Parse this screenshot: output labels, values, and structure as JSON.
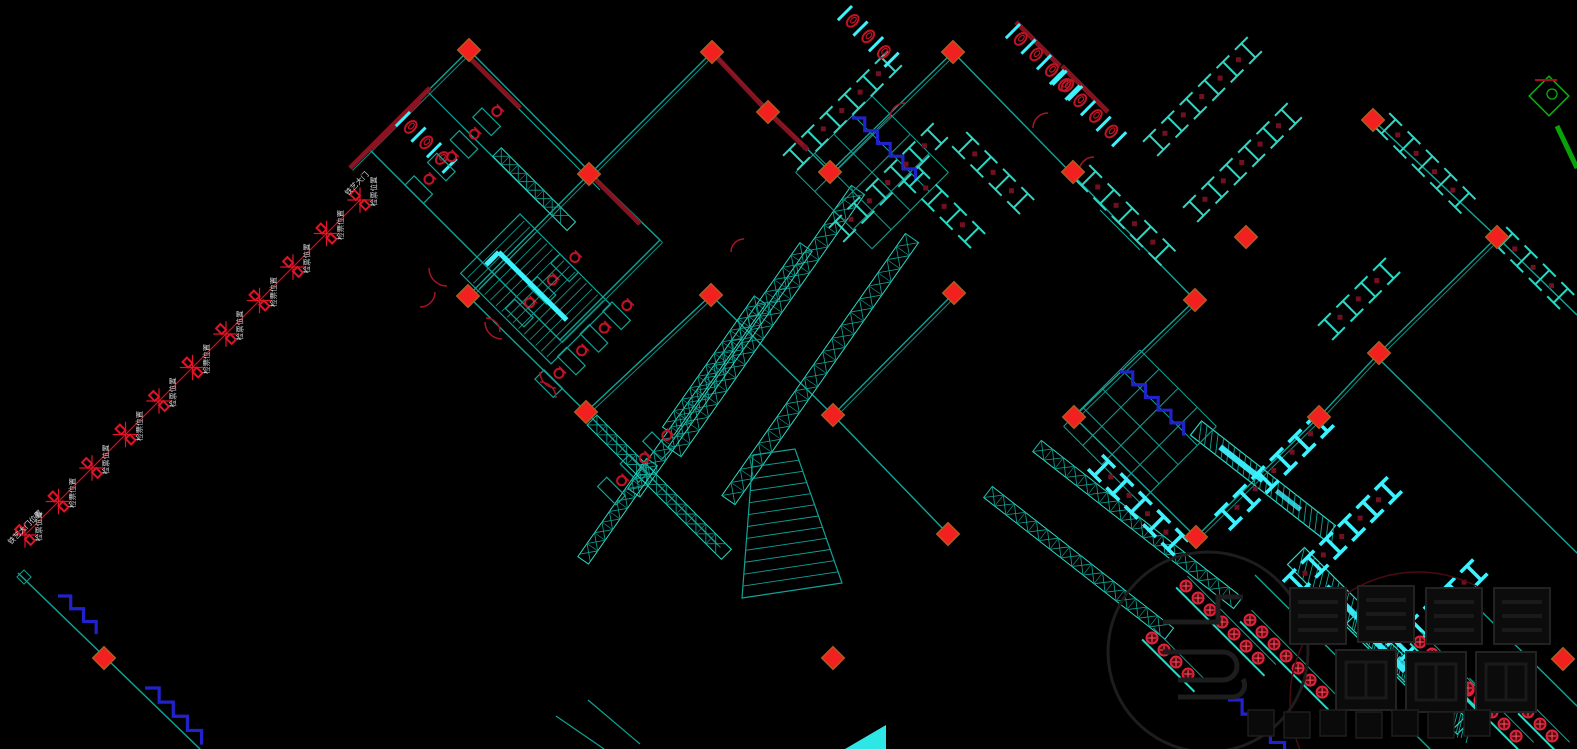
{
  "canvas": {
    "width": 1577,
    "height": 749,
    "background": "#000000"
  },
  "colors": {
    "background": "#000000",
    "wall": "#0fa396",
    "wall_light": "#2bd9c4",
    "bright": "#3df2ff",
    "column": "#f32020",
    "column_edge": "#b05a20",
    "dark_red": "#8e1322",
    "chair_red": "#c01326",
    "door_red": "#a61427",
    "blue": "#2222cc",
    "label": "#d4d6d8",
    "watermark": "#1d1d1d",
    "green": "#0bb40b"
  },
  "queue": {
    "x1": 360,
    "y1": 200,
    "x2": 25,
    "y2": 535,
    "gates": 11,
    "gate_label": "检票位置",
    "top_label": "铁艺大门",
    "bottom_label": "铁艺大门位置"
  },
  "markers": {
    "column_diamonds": [
      [
        469,
        50
      ],
      [
        712,
        52
      ],
      [
        768,
        112
      ],
      [
        953,
        52
      ],
      [
        830,
        172
      ],
      [
        1073,
        172
      ],
      [
        589,
        174
      ],
      [
        468,
        296
      ],
      [
        711,
        295
      ],
      [
        954,
        293
      ],
      [
        586,
        412
      ],
      [
        833,
        415
      ],
      [
        1195,
        300
      ],
      [
        1074,
        417
      ],
      [
        1319,
        417
      ],
      [
        1196,
        537
      ],
      [
        1379,
        353
      ],
      [
        1497,
        237
      ],
      [
        1373,
        120
      ],
      [
        1246,
        237
      ],
      [
        948,
        534
      ],
      [
        104,
        658
      ],
      [
        833,
        658
      ],
      [
        1563,
        659
      ]
    ],
    "small_outline_diamonds": [
      [
        24,
        577
      ]
    ]
  },
  "elements": {
    "walls": [
      {
        "pts": [
          [
            350,
            168
          ],
          [
            469,
            50
          ],
          [
            591,
            173
          ],
          [
            712,
            52
          ],
          [
            830,
            172
          ],
          [
            953,
            52
          ],
          [
            1195,
            300
          ]
        ]
      },
      {
        "pts": [
          [
            1195,
            300
          ],
          [
            1074,
            417
          ],
          [
            1196,
            537
          ]
        ]
      },
      {
        "pts": [
          [
            1196,
            537
          ],
          [
            1319,
            417
          ],
          [
            1379,
            353
          ]
        ]
      },
      {
        "pts": [
          [
            1373,
            120
          ],
          [
            1497,
            237
          ],
          [
            1379,
            353
          ]
        ]
      },
      {
        "pts": [
          [
            468,
            296
          ],
          [
            586,
            412
          ],
          [
            711,
            295
          ]
        ]
      },
      {
        "pts": [
          [
            370,
            150
          ],
          [
            560,
            340
          ],
          [
            660,
            240
          ]
        ]
      },
      {
        "pts": [
          [
            589,
            174
          ],
          [
            468,
            296
          ]
        ]
      },
      {
        "pts": [
          [
            660,
            240
          ],
          [
            591,
            173
          ]
        ]
      },
      {
        "pts": [
          [
            586,
            412
          ],
          [
            718,
            545
          ]
        ]
      },
      {
        "pts": [
          [
            954,
            293
          ],
          [
            833,
            415
          ],
          [
            948,
            534
          ]
        ]
      },
      {
        "pts": [
          [
            711,
            295
          ],
          [
            833,
            415
          ]
        ]
      },
      {
        "pts": [
          [
            1497,
            237
          ],
          [
            1577,
            315
          ]
        ]
      },
      {
        "pts": [
          [
            1380,
            360
          ],
          [
            1577,
            553
          ]
        ]
      },
      {
        "pts": [
          [
            1255,
            575
          ],
          [
            1430,
            749
          ]
        ]
      },
      {
        "pts": [
          [
            1480,
            610
          ],
          [
            1577,
            706
          ]
        ]
      },
      {
        "pts": [
          [
            18,
            573
          ],
          [
            200,
            749
          ]
        ]
      }
    ],
    "lines": [
      [
        428,
        92,
        520,
        184
      ],
      [
        462,
        126,
        540,
        204
      ],
      [
        500,
        90,
        560,
        150
      ],
      [
        548,
        138,
        600,
        190
      ],
      [
        556,
        716,
        604,
        749
      ],
      [
        588,
        700,
        640,
        744
      ],
      [
        1100,
        210,
        1140,
        250
      ]
    ],
    "red_segments": [
      [
        350,
        168,
        430,
        88
      ],
      [
        712,
        52,
        768,
        112
      ],
      [
        768,
        112,
        808,
        150
      ],
      [
        1016,
        22,
        1060,
        66
      ],
      [
        1062,
        66,
        1108,
        112
      ],
      [
        372,
        148,
        420,
        100
      ],
      [
        596,
        180,
        640,
        224
      ],
      [
        470,
        58,
        520,
        108
      ]
    ],
    "trusses": [
      {
        "x": 858,
        "y": 190,
        "rot": 125,
        "len": 320,
        "w": 16
      },
      {
        "x": 912,
        "y": 238,
        "rot": 125,
        "len": 320,
        "w": 16
      },
      {
        "x": 806,
        "y": 247,
        "rot": 125,
        "len": 300,
        "w": 15
      },
      {
        "x": 760,
        "y": 300,
        "rot": 125,
        "len": 160,
        "w": 14
      },
      {
        "x": 592,
        "y": 420,
        "rot": 45,
        "len": 190,
        "w": 14
      },
      {
        "x": 497,
        "y": 152,
        "rot": 45,
        "len": 105,
        "w": 12
      },
      {
        "x": 1037,
        "y": 446,
        "rot": 38,
        "len": 255,
        "w": 14
      },
      {
        "x": 988,
        "y": 492,
        "rot": 38,
        "len": 230,
        "w": 14
      },
      {
        "x": 652,
        "y": 462,
        "rot": 125,
        "len": 120,
        "w": 13
      }
    ],
    "hatches": [
      {
        "x": 1296,
        "y": 556,
        "rot": 45,
        "len": 240,
        "w": 24
      },
      {
        "x": 1196,
        "y": 428,
        "rot": 38,
        "len": 170,
        "w": 18
      },
      {
        "x": 1352,
        "y": 618,
        "rot": 45,
        "len": 150,
        "w": 20
      }
    ],
    "gate_rows": [
      {
        "x": 800,
        "y": 160,
        "ang": -45,
        "n": 6,
        "bright": false
      },
      {
        "x": 846,
        "y": 232,
        "ang": -45,
        "n": 6,
        "bright": false
      },
      {
        "x": 1085,
        "y": 182,
        "ang": 45,
        "n": 5,
        "bright": false
      },
      {
        "x": 1160,
        "y": 146,
        "ang": -45,
        "n": 6,
        "bright": false
      },
      {
        "x": 1200,
        "y": 212,
        "ang": -45,
        "n": 6,
        "bright": false
      },
      {
        "x": 1385,
        "y": 130,
        "ang": 45,
        "n": 5,
        "bright": false
      },
      {
        "x": 913,
        "y": 183,
        "ang": 45,
        "n": 4,
        "bright": false
      },
      {
        "x": 962,
        "y": 149,
        "ang": 45,
        "n": 4,
        "bright": false
      },
      {
        "x": 1335,
        "y": 330,
        "ang": -45,
        "n": 4,
        "bright": false
      },
      {
        "x": 1502,
        "y": 244,
        "ang": 45,
        "n": 4,
        "bright": false
      },
      {
        "x": 1232,
        "y": 520,
        "ang": -45,
        "n": 6,
        "bright": true
      },
      {
        "x": 1300,
        "y": 586,
        "ang": -45,
        "n": 6,
        "bright": true
      },
      {
        "x": 1404,
        "y": 650,
        "ang": -45,
        "n": 5,
        "bright": true
      },
      {
        "x": 1098,
        "y": 472,
        "ang": 45,
        "n": 5,
        "bright": true
      }
    ],
    "grids": [
      {
        "x": 872,
        "y": 96,
        "rot": 45,
        "cols": 4,
        "rows": 4,
        "cell": 27
      },
      {
        "x": 1140,
        "y": 350,
        "rot": 45,
        "cols": 4,
        "rows": 4,
        "cell": 27
      }
    ],
    "stall_rows": [
      {
        "x": 1020,
        "y": 24,
        "rot": 45,
        "n": 4
      },
      {
        "x": 1064,
        "y": 70,
        "rot": 45,
        "n": 4
      },
      {
        "x": 852,
        "y": 6,
        "rot": 45,
        "n": 3
      },
      {
        "x": 410,
        "y": 112,
        "rot": 45,
        "n": 3
      }
    ],
    "desk_groups": [
      {
        "x": 482,
        "y": 108,
        "rot": 45,
        "n": 4
      },
      {
        "x": 612,
        "y": 302,
        "rot": 45,
        "n": 4
      },
      {
        "x": 652,
        "y": 432,
        "rot": 45,
        "n": 3
      },
      {
        "x": 560,
        "y": 254,
        "rot": 45,
        "n": 3
      }
    ],
    "stairs": [
      {
        "x": 520,
        "y": 214,
        "rot": 45,
        "w": 128,
        "h": 84
      }
    ],
    "bench_rows": [
      {
        "x": 1186,
        "y": 586,
        "ang": 45,
        "n": 7
      },
      {
        "x": 1250,
        "y": 620,
        "ang": 45,
        "n": 7
      },
      {
        "x": 1152,
        "y": 638,
        "ang": 45,
        "n": 4
      },
      {
        "x": 1420,
        "y": 642,
        "ang": 45,
        "n": 6
      },
      {
        "x": 1468,
        "y": 688,
        "ang": 45,
        "n": 5
      },
      {
        "x": 1528,
        "y": 712,
        "ang": 45,
        "n": 3
      }
    ],
    "zigzags": [
      {
        "x": 58,
        "y": 596,
        "n": 3,
        "s": 9
      },
      {
        "x": 145,
        "y": 688,
        "n": 4,
        "s": 10
      },
      {
        "x": 1228,
        "y": 700,
        "n": 5,
        "s": 10
      },
      {
        "x": 852,
        "y": 118,
        "n": 5,
        "s": 9
      },
      {
        "x": 1120,
        "y": 372,
        "n": 5,
        "s": 9
      }
    ],
    "arcs": [
      {
        "x": 447,
        "y": 268,
        "r": 18,
        "a1": 90,
        "a2": 180
      },
      {
        "x": 502,
        "y": 322,
        "r": 17,
        "a1": 90,
        "a2": 180
      },
      {
        "x": 556,
        "y": 372,
        "r": 16,
        "a1": 90,
        "a2": 180
      },
      {
        "x": 905,
        "y": 118,
        "r": 15,
        "a1": 180,
        "a2": 270
      },
      {
        "x": 1048,
        "y": 128,
        "r": 15,
        "a1": 180,
        "a2": 270
      },
      {
        "x": 1094,
        "y": 172,
        "r": 15,
        "a1": 180,
        "a2": 270
      },
      {
        "x": 744,
        "y": 252,
        "r": 13,
        "a1": 180,
        "a2": 270
      },
      {
        "x": 420,
        "y": 292,
        "r": 15,
        "a1": 0,
        "a2": 90
      },
      {
        "x": 540,
        "y": 398,
        "r": 16,
        "a1": 270,
        "a2": 360
      },
      {
        "x": 486,
        "y": 332,
        "r": 14,
        "a1": 270,
        "a2": 360
      }
    ],
    "fan": {
      "pts": [
        [
          753,
          455
        ],
        [
          795,
          449
        ],
        [
          842,
          583
        ],
        [
          742,
          598
        ]
      ],
      "rungs": 12
    },
    "triangle": [
      [
        845,
        749
      ],
      [
        886,
        749
      ],
      [
        886,
        725
      ]
    ],
    "green_corner": {
      "x": 1549,
      "y": 96
    },
    "dark_arc": {
      "x": 1418,
      "y": 700,
      "r": 128
    }
  },
  "watermark": {
    "circle": {
      "cx": 1208,
      "cy": 652,
      "r": 100
    },
    "block_size": 56,
    "blocks_row1": [
      [
        1290,
        588
      ],
      [
        1358,
        586
      ],
      [
        1426,
        588
      ],
      [
        1494,
        588
      ]
    ],
    "block2_size": 60,
    "blocks_row2": [
      [
        1336,
        650
      ],
      [
        1406,
        652
      ],
      [
        1476,
        652
      ]
    ],
    "small_size": 26,
    "small_row": [
      [
        1248,
        710
      ],
      [
        1284,
        712
      ],
      [
        1320,
        710
      ],
      [
        1356,
        712
      ],
      [
        1392,
        710
      ],
      [
        1428,
        712
      ],
      [
        1464,
        710
      ]
    ]
  }
}
